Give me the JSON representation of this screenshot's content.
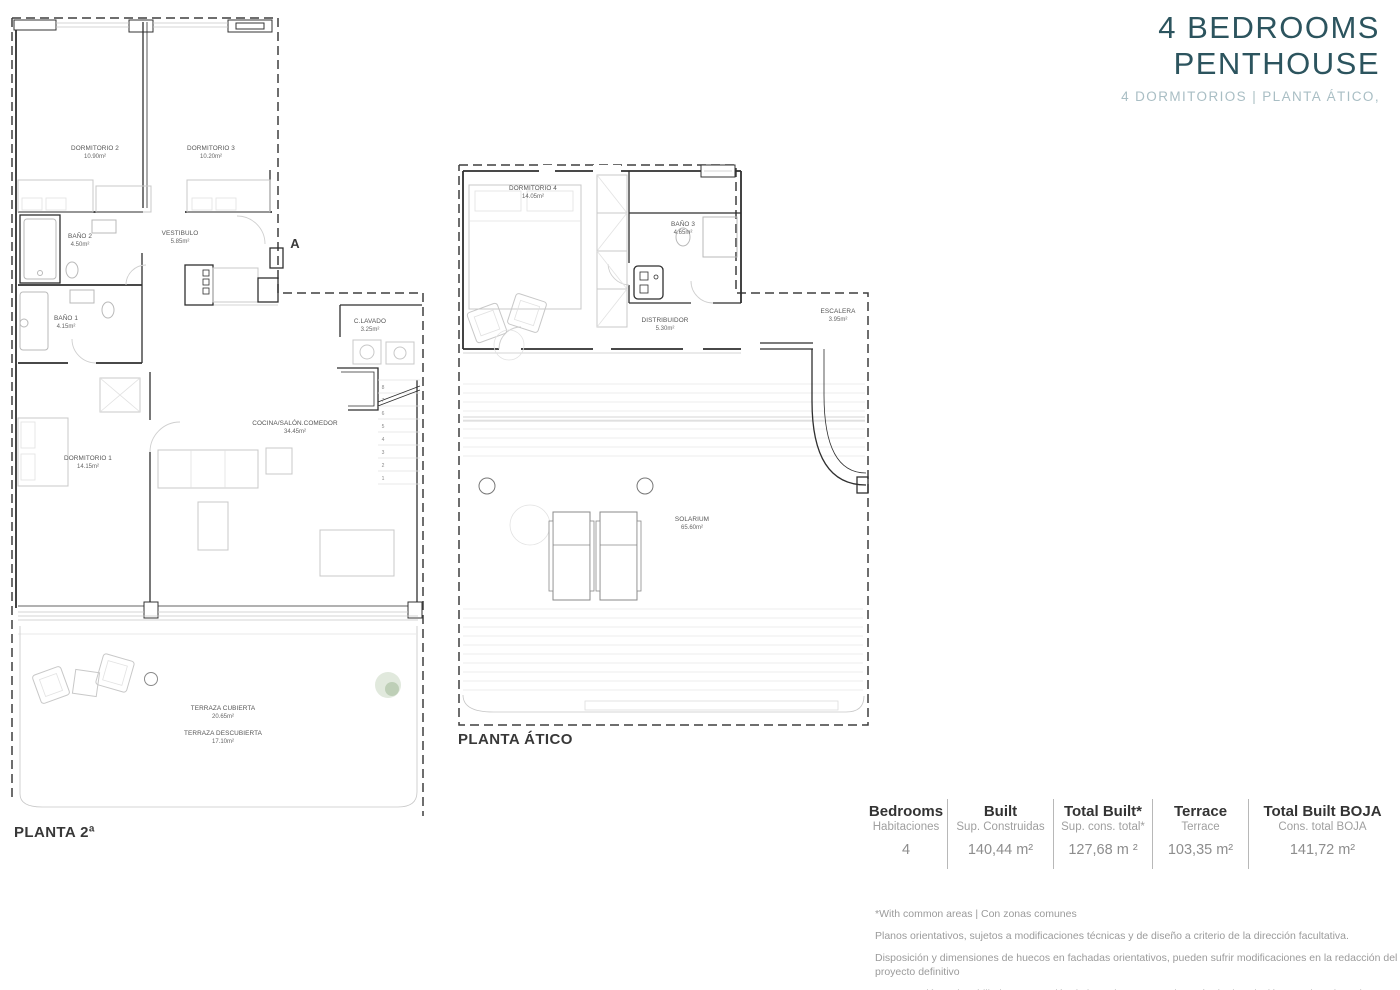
{
  "header": {
    "title_line1": "4 BEDROOMS",
    "title_line2": "PENTHOUSE",
    "subtitle": "4 DORMITORIOS | PLANTA ÁTICO,"
  },
  "plans": {
    "planta2": {
      "label": "PLANTA 2ª",
      "section_marker": "A",
      "rooms": {
        "dormitorio2": {
          "name": "DORMITORIO 2",
          "area": "10.90m²"
        },
        "dormitorio3": {
          "name": "DORMITORIO 3",
          "area": "10.20m²"
        },
        "bano2": {
          "name": "BAÑO 2",
          "area": "4.50m²"
        },
        "vestibulo": {
          "name": "VESTIBULO",
          "area": "5.85m²"
        },
        "bano1": {
          "name": "BAÑO 1",
          "area": "4.15m²"
        },
        "clavado": {
          "name": "C.LAVADO",
          "area": "3.25m²"
        },
        "cocina": {
          "name": "COCINA/SALÓN.COMEDOR",
          "area": "34.45m²"
        },
        "dormitorio1": {
          "name": "DORMITORIO 1",
          "area": "14.15m²"
        },
        "terraza_cubierta": {
          "name": "TERRAZA CUBIERTA",
          "area": "20.65m²"
        },
        "terraza_descubierta": {
          "name": "TERRAZA DESCUBIERTA",
          "area": "17.10m²"
        }
      },
      "stair_steps": [
        "8",
        "7",
        "6",
        "5",
        "4",
        "3",
        "2",
        "1"
      ]
    },
    "atico": {
      "label": "PLANTA ÁTICO",
      "rooms": {
        "dormitorio4": {
          "name": "DORMITORIO 4",
          "area": "14.05m²"
        },
        "bano3": {
          "name": "BAÑO 3",
          "area": "4.65m²"
        },
        "distribuidor": {
          "name": "DISTRIBUIDOR",
          "area": "5.30m²"
        },
        "escalera": {
          "name": "ESCALERA",
          "area": "3.95m²"
        },
        "solarium": {
          "name": "SOLARIUM",
          "area": "65.60m²"
        }
      }
    }
  },
  "summary": {
    "columns": [
      {
        "label_en": "Bedrooms",
        "label_es": "Habitaciones",
        "value": "4"
      },
      {
        "label_en": "Built",
        "label_es": "Sup. Construidas",
        "value": "140,44 m²"
      },
      {
        "label_en": "Total Built*",
        "label_es": "Sup. cons. total*",
        "value": "127,68 m ²"
      },
      {
        "label_en": "Terrace",
        "label_es": "Terrace",
        "value": "103,35 m²"
      },
      {
        "label_en": "Total Built BOJA",
        "label_es": "Cons. total BOJA",
        "value": "141,72 m²"
      }
    ]
  },
  "footnotes": {
    "note1": "*With common areas | Con zonas comunes",
    "note2": "Planos orientativos, sujetos a modificaciones técnicas y de diseño a criterio de la dirección facultativa.",
    "note3": "Disposición y dimensiones de huecos en fachadas orientativos, pueden sufrir modificaciones en la redacción del proyecto definitivo",
    "note4": "La vegetación y el mobiliario, a excepción de la cocina, que se ajustará a la descripción mencionada en la memoria de calidades, tienen carácter exclusivamente estético, no siendo en ningún caso objeto de compraventa."
  },
  "colors": {
    "title": "#2c545e",
    "subtitle": "#a9bec4",
    "wall": "#2f2f2f",
    "furniture": "#c8c8c8"
  }
}
